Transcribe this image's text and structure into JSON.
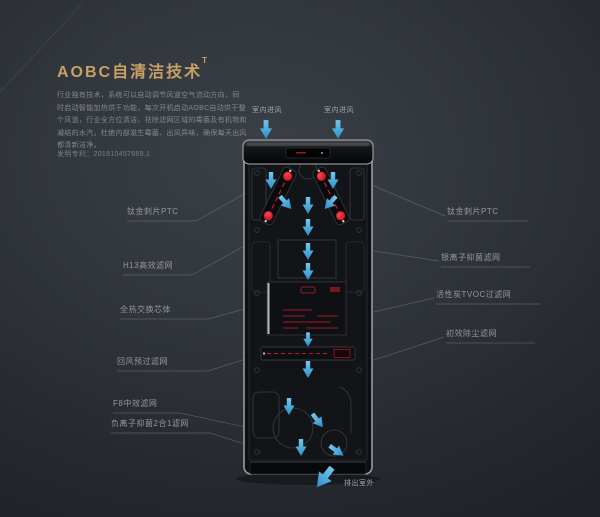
{
  "header": {
    "title": "AOBC自清洁技术",
    "superscript": "T",
    "description_lines": [
      "行业独有技术，系统可以自动调节风道空气流动方向，同",
      "时启动智能加热烘干功能，每次开机启动AOBC自动烘干整",
      "个风道，行业全方位清洁，祛除滤网区域的霉菌及有机物和",
      "凝结的水汽，杜绝内部滋生霉菌、出风异味，确保每天出风",
      "都清新洁净。"
    ],
    "patent": "发明专利：201810457669.1"
  },
  "airflow": {
    "top_left_label": "室内进风",
    "top_right_label": "室内进风",
    "bottom_label": "排出室外"
  },
  "callouts": {
    "left": [
      {
        "label": "钛金刺片PTC"
      },
      {
        "label": "H13高效滤网"
      },
      {
        "label": "全热交换芯体"
      },
      {
        "label": "回风预过滤网"
      },
      {
        "label": "F8中效滤网"
      },
      {
        "label": "负离子抑菌2合1滤网"
      }
    ],
    "right": [
      {
        "label": "钛金刺片PTC"
      },
      {
        "label": "银离子抑菌滤网"
      },
      {
        "label": "活性炭TVOC过滤网"
      },
      {
        "label": "初效除尘滤网"
      }
    ]
  },
  "colors": {
    "accent": "#c9a066",
    "arrow_blue": "#3aa0d9",
    "arrow_blue_light": "#74c7ef",
    "heater_red": "#e11e2e",
    "label_gray": "#95989d",
    "body_silver": "#989ca1"
  }
}
